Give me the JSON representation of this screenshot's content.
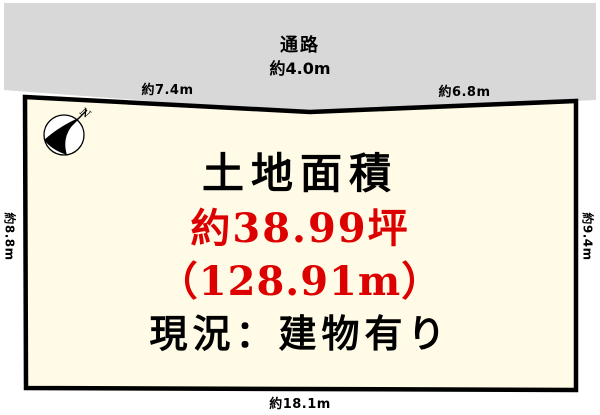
{
  "road": {
    "name": "通路",
    "width": "約4.0m"
  },
  "dimensions": {
    "top_left": "約7.4m",
    "top_right": "約6.8m",
    "left_side": "約8.8m",
    "right_side": "約9.4m",
    "bottom": "約18.1m"
  },
  "plot": {
    "title": "土地面積",
    "area_tsubo": "約38.99坪",
    "area_sqm": "（128.91m）",
    "status": "現況：建物有り"
  },
  "compass": {
    "north_label": "N"
  },
  "colors": {
    "road_fill": "#d8d8d8",
    "plot_fill": "#fffbe6",
    "outline": "#000000",
    "accent_red": "#dd0000"
  }
}
